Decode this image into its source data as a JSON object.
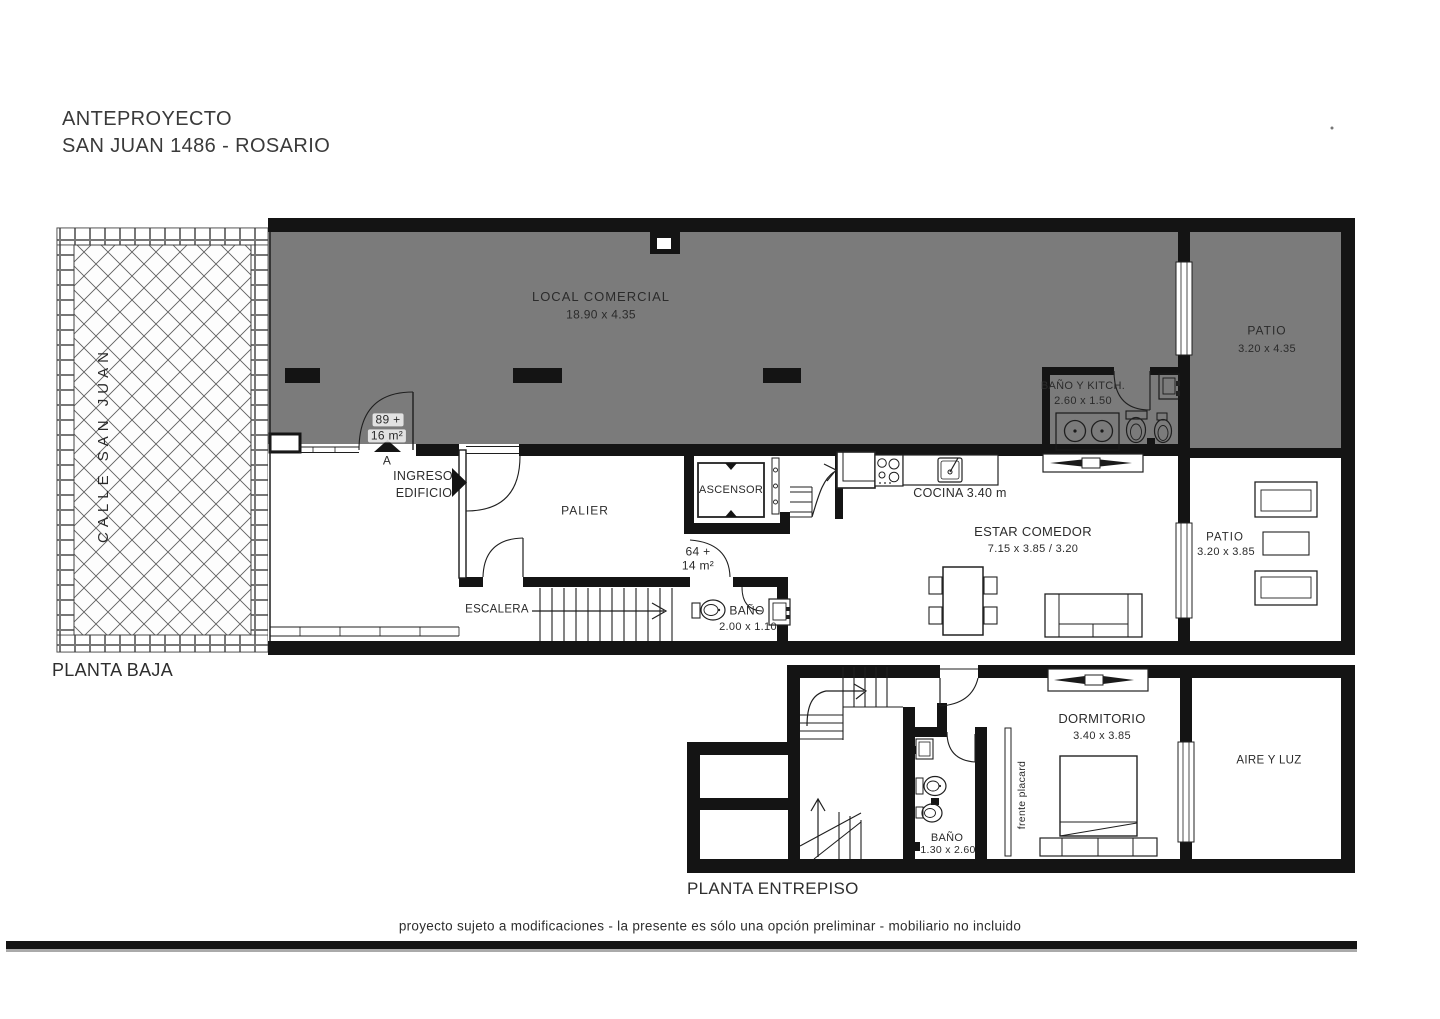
{
  "title": {
    "line1": "ANTEPROYECTO",
    "line2": "SAN JUAN 1486 - ROSARIO"
  },
  "street": {
    "label": "CALLE SAN JUAN"
  },
  "planta_baja": {
    "label": "PLANTA BAJA",
    "local_comercial": {
      "name": "LOCAL COMERCIAL",
      "dims": "18.90 x 4.35",
      "area_line1": "89 +",
      "area_line2": "16 m²",
      "door": "A"
    },
    "patio_superior": {
      "name": "PATIO",
      "dims": "3.20 x 4.35"
    },
    "bano_kitch": {
      "name": "BAÑO Y KITCH.",
      "dims": "2.60 x 1.50"
    },
    "ingreso": {
      "line1": "INGRESO",
      "line2": "EDIFICIO"
    },
    "palier": {
      "name": "PALIER"
    },
    "ascensor": {
      "name": "ASCENSOR"
    },
    "depto": {
      "area_line1": "64 +",
      "area_line2": "14 m²"
    },
    "escalera": {
      "name": "ESCALERA"
    },
    "bano": {
      "name": "BAÑO",
      "dims": "2.00 x 1.10"
    },
    "cocina": {
      "name": "COCINA 3.40 m"
    },
    "estar_comedor": {
      "name": "ESTAR COMEDOR",
      "dims": "7.15 x 3.85 / 3.20"
    },
    "patio_inferior": {
      "name": "PATIO",
      "dims": "3.20 x 3.85"
    }
  },
  "planta_entrepiso": {
    "label": "PLANTA ENTREPISO",
    "dormitorio": {
      "name": "DORMITORIO",
      "dims": "3.40 x 3.85"
    },
    "aire_y_luz": {
      "name": "AIRE Y LUZ"
    },
    "bano": {
      "name": "BAÑO",
      "dims": "1.30 x 2.60"
    },
    "placard": {
      "label": "frente placard"
    }
  },
  "footer": {
    "disclaimer": "proyecto sujeto a modificaciones - la presente es sólo una opción preliminar - mobiliario no incluido"
  },
  "colors": {
    "room_gray": "#7b7b7b",
    "wall": "#141414",
    "paper": "#ffffff"
  }
}
